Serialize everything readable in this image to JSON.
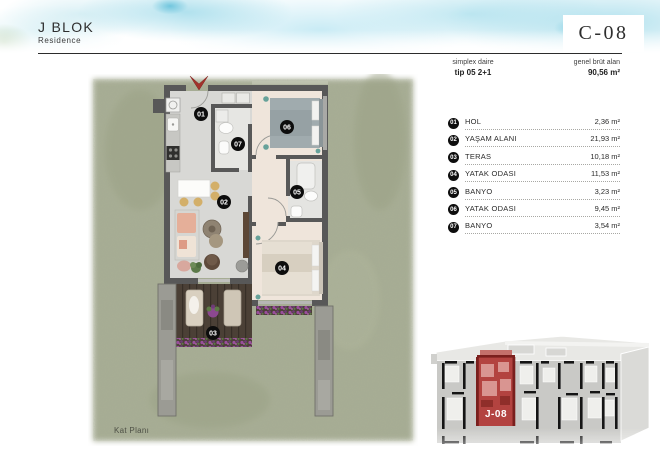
{
  "header": {
    "block_title": "J BLOK",
    "block_subtitle": "Residence",
    "unit_code": "C-08",
    "type_line1": "simplex daire",
    "type_line2": "tip 05 2+1",
    "area_line1": "genel brüt alan",
    "area_line2": "90,56 m²"
  },
  "plan": {
    "caption": "Kat Planı",
    "rooms": [
      {
        "num": "01",
        "name": "HOL",
        "area": "2,36 m²"
      },
      {
        "num": "02",
        "name": "YAŞAM ALANI",
        "area": "21,93 m²"
      },
      {
        "num": "03",
        "name": "TERAS",
        "area": "10,18 m²"
      },
      {
        "num": "04",
        "name": "YATAK ODASI",
        "area": "11,53 m²"
      },
      {
        "num": "05",
        "name": "BANYO",
        "area": "3,23 m²"
      },
      {
        "num": "06",
        "name": "YATAK ODASI",
        "area": "9,45 m²"
      },
      {
        "num": "07",
        "name": "BANYO",
        "area": "3,54 m²"
      }
    ]
  },
  "site_plan": {
    "unit_label": "J-08"
  },
  "colors": {
    "grass": "#a8ae95",
    "wall_gray": "#585858",
    "entrance_arrow_red": "#a2322c",
    "highlight_red": "#b34340",
    "watercolor_blue": "#8fd0e2",
    "badge_black": "#0d0d0d"
  }
}
